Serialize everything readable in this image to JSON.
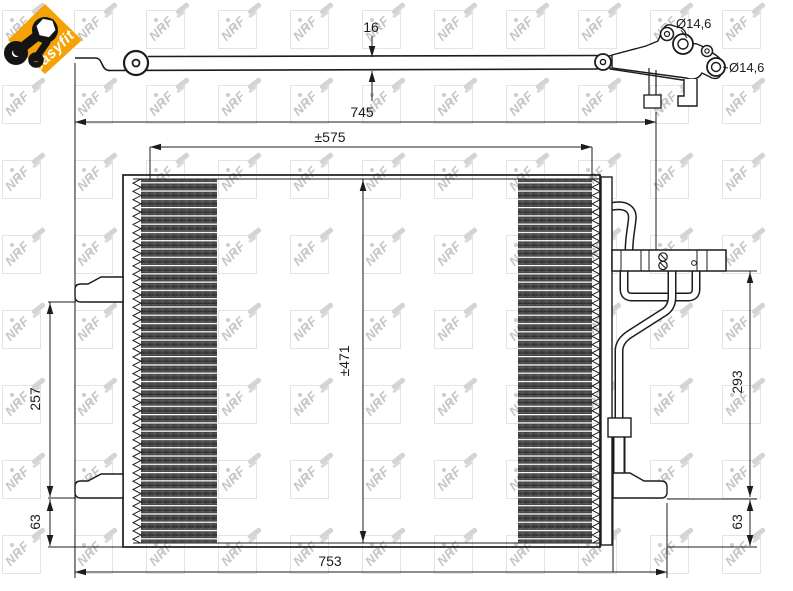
{
  "badge": {
    "label": "easyfit",
    "background_color": "#F5A206",
    "icon": "wrench-icon"
  },
  "watermark": {
    "text": "NRF",
    "color": "#c6c6c6"
  },
  "drawing": {
    "line_color": "#1c1c1c",
    "top_view": {
      "thickness": "16",
      "upper_port_diameter": "Ø14,6",
      "lower_port_diameter": "Ø14,6"
    },
    "front_view": {
      "overall_width": "745",
      "mounting_width": "±575",
      "core_height": "±471",
      "left_bracket_span": "257",
      "left_bottom_offset": "63",
      "total_width": "753",
      "right_pipe_drop": "293",
      "right_bottom_offset": "63"
    }
  }
}
